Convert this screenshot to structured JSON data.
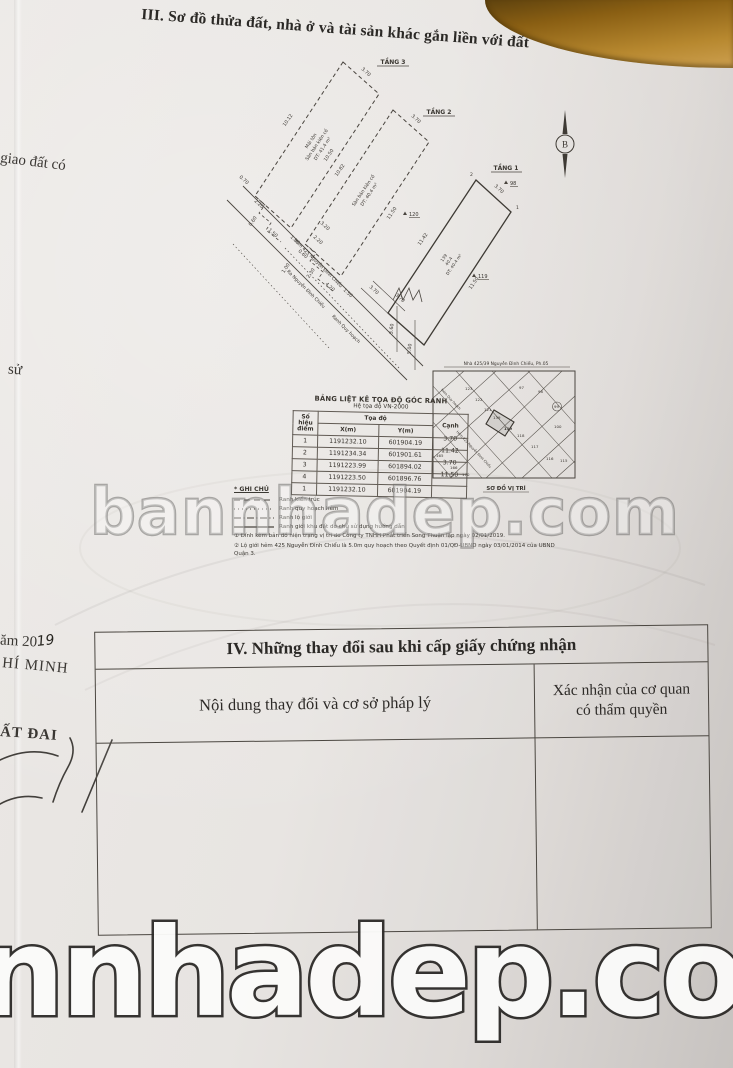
{
  "doc": {
    "section3_title": "III. Sơ đồ thửa đất, nhà ở và tài sản khác gắn liền với đất",
    "edge_fragments": {
      "f1": "giao đất có",
      "f2": "sử",
      "f3_printed": "ăm 20",
      "f3_hand": "19",
      "f4": "HÍ MINH",
      "f5": "ẤT ĐAI"
    }
  },
  "plan": {
    "north_label": "B",
    "floors": {
      "t3": {
        "name": "TẦNG 3",
        "lines": [
          "Mái tôn",
          "Sàn bán kiên cố",
          "DT: 41.4 m²"
        ],
        "dims": [
          "3.70",
          "10.12",
          "10.50",
          "0.70",
          "2.20",
          "0.60",
          "1.50",
          "1.30"
        ]
      },
      "t2": {
        "name": "TẦNG 2",
        "lines": [
          "Sàn bán kiên cố",
          "DT: 40.4 m²"
        ],
        "dims": [
          "3.70",
          "10.82",
          "11.50",
          "0.60",
          "2.20",
          "2.30",
          "3.20",
          "4.20",
          "1.50",
          "1.00"
        ]
      },
      "t1": {
        "name": "TẦNG 1",
        "lines": [
          "139",
          "40.4",
          "DT: 40.4 m²"
        ],
        "dims": [
          "3.70",
          "11.42",
          "11.50",
          "3.70",
          "3.60",
          "5.00"
        ],
        "corners": [
          "2",
          "1"
        ]
      }
    },
    "parcel_refs": [
      "120",
      "98",
      "119"
    ],
    "street1": "Hẻm 425 Nguyễn Đình Chiểu",
    "street2": "Ra Nguyễn Đình Chiểu",
    "boundary_label": "Ranh Quy hoạch"
  },
  "coord_table": {
    "title": "BẢNG LIỆT KÊ TỌA ĐỘ GÓC RANH",
    "subtitle": "Hệ tọa độ VN-2000",
    "headers": {
      "point": "Số hiệu điểm",
      "coord": "Tọa độ",
      "x": "X(m)",
      "y": "Y(m)",
      "edge": "Cạnh"
    },
    "rows": [
      {
        "p": "1",
        "x": "1191232.10",
        "y": "601904.19",
        "c": "3.70"
      },
      {
        "p": "2",
        "x": "1191234.34",
        "y": "601901.61",
        "c": "11.42"
      },
      {
        "p": "3",
        "x": "1191223.99",
        "y": "601894.02",
        "c": "3.70"
      },
      {
        "p": "4",
        "x": "1191223.50",
        "y": "601896.76",
        "c": "11.50"
      },
      {
        "p": "1",
        "x": "1191232.10",
        "y": "601904.19",
        "c": ""
      }
    ]
  },
  "location_map": {
    "title": "Nhà 425/39 Nguyễn Đình Chiểu, Ph.05",
    "caption": "SƠ ĐỒ VỊ TRÍ",
    "street": "Hẻm 425 Nguyễn Đình Chiểu",
    "street2": "Hẻm Quy hoạch",
    "parcels": [
      "123",
      "122",
      "121",
      "97",
      "98",
      "99",
      "100",
      "139",
      "119",
      "118",
      "117",
      "116",
      "115",
      "165",
      "166",
      "170"
    ]
  },
  "notes": {
    "heading": "* GHI CHÚ",
    "legend": [
      {
        "label": "Ranh kiến trúc"
      },
      {
        "label": "Ranh quy hoạch hẻm"
      },
      {
        "label": "Ranh lộ giới"
      },
      {
        "label": "Ranh giới khu đất do chủ sử dụng hướng dẫn"
      }
    ],
    "items": [
      "① Đính kèm bản đồ hiện trạng vị trí do Công ty TNHH Phát triển Song Thuận lập ngày 02/01/2019.",
      "② Lộ giới hẻm 425 Nguyễn Đình Chiểu là 5.0m quy hoạch theo Quyết định 01/QĐ-UBND ngày 03/01/2014 của UBND Quận 3."
    ]
  },
  "section4": {
    "title": "IV. Những thay đổi sau khi cấp giấy chứng nhận",
    "col1": "Nội dung thay đổi và cơ sở pháp lý",
    "col2": "Xác nhận của cơ quan có thẩm quyền"
  },
  "watermark": {
    "middle": "bannhadep.com",
    "bottom": "nnhadep.com"
  }
}
